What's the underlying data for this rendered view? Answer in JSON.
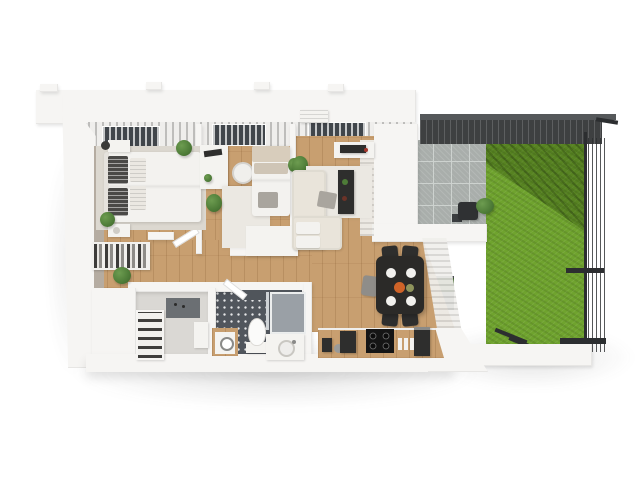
{
  "title": "3d-apartment-floor-plan-render",
  "palette": {
    "bg": "#ffffff",
    "wall": "#f6f5f3",
    "wall_shade": "#e7e5e2",
    "greige": "#b5aca1",
    "wood": "#c89f70",
    "wood_line": "rgba(113,70,30,0.18)",
    "rug": "#dcd8d0",
    "rug_light": "#ebe8e2",
    "furn_white": "#f4f3f0",
    "dark": "#2e2e2d",
    "pillow_dark": "#4a4947",
    "pillow_grey": "#a9a59e",
    "sofa": "#e9e4da",
    "bed_white": "#f3f2ef",
    "beige": "#d8cdbc",
    "plant": "#4e7c38",
    "plant_dark": "#3c6029",
    "orange": "#cf6328",
    "blind_band": "#efeeec",
    "blind_stripe": "rgba(130,130,128,0.45)",
    "window_dark": "#41464b",
    "glass_stripe_a": "#d6d5d2",
    "glass_stripe_b": "#f0efec",
    "tile": "#a9aeab",
    "tile_line": "#cdd2cf",
    "pergola": "#3e4041",
    "railing": "#2c2e30",
    "grass": "#6fa32e",
    "grass_shade": "rgba(25,50,0,0.28)",
    "bath_floor": "#51565d",
    "bath_wall": "#9aa0a6",
    "bath_dark": "#50555b",
    "entry_floor": "#dad8d4",
    "shadow": "rgba(60,60,60,0.14)"
  },
  "scene": {
    "type": "3d-floor-plan-render",
    "view": "top-down cutaway",
    "rooms": [
      {
        "name": "master-bedroom",
        "floor": "wood",
        "furniture": [
          "double-bed",
          "striped-pillows",
          "grey-rug",
          "nightstand-top",
          "nightstand-bottom",
          "table-lamp",
          "potted-plants",
          "open-clothes-rack"
        ]
      },
      {
        "name": "second-bedroom",
        "floor": "wood",
        "furniture": [
          "white-desk",
          "desk-chair",
          "single-bed",
          "white-rug",
          "bookshelf",
          "potted-plants"
        ]
      },
      {
        "name": "living-room",
        "floor": "wood",
        "furniture": [
          "corner-sofa",
          "dark-coffee-table",
          "light-rug",
          "tv-sideboard",
          "potted-plant"
        ]
      },
      {
        "name": "dining-area",
        "floor": "wood",
        "furniture": [
          "black-dining-table",
          "four-black-chairs",
          "grey-chair",
          "white-plates",
          "orange-bowl"
        ]
      },
      {
        "name": "kitchen",
        "floor": "wood",
        "furniture": [
          "wood-counter",
          "cooktop-4-burners",
          "oven",
          "coffee-machine",
          "canisters",
          "grinder",
          "pot"
        ]
      },
      {
        "name": "bathroom",
        "floor": "patterned-mosaic",
        "furniture": [
          "toilet",
          "vanity-with-sink",
          "shower",
          "washing-machine",
          "dark-accent-wall",
          "open-door"
        ]
      },
      {
        "name": "entry-hall",
        "floor": "grey",
        "furniture": [
          "slatted-shoe-rack",
          "dark-wall-panel",
          "small-sink"
        ]
      },
      {
        "name": "balcony",
        "floor": "tiles-and-artificial-grass",
        "furniture": [
          "slatted-pergola",
          "metal-mesh-railing",
          "outdoor-chair",
          "outdoor-side-table",
          "green-bush",
          "dark-planter",
          "white-parapet"
        ]
      }
    ],
    "windows": [
      "master-bedroom-window-with-blinds",
      "second-bedroom-window-with-blinds",
      "living-room-window-with-blinds",
      "glass-wall-living-to-balcony",
      "glass-wall-dining-to-balcony"
    ]
  }
}
